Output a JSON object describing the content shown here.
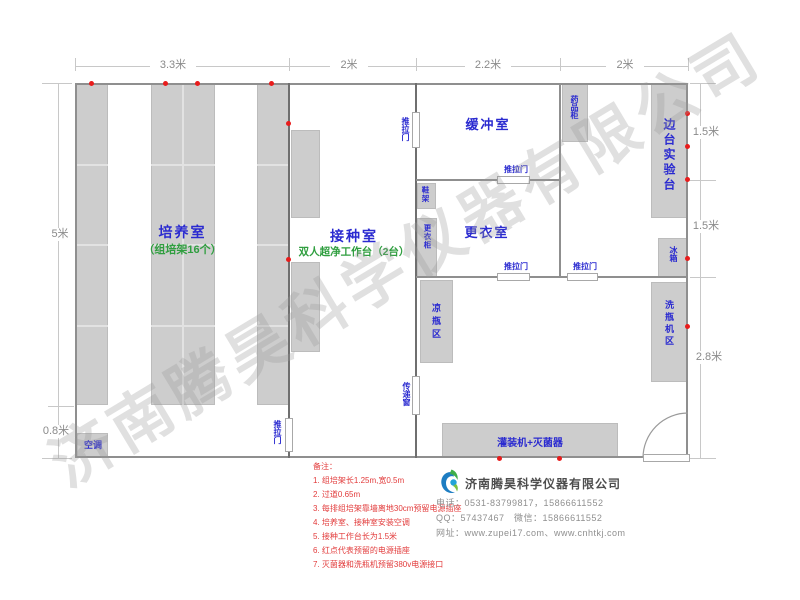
{
  "watermark": "济南腾昊科学仪器有限公司",
  "dimensions": {
    "top": [
      "3.3米",
      "2米",
      "2.2米",
      "2米"
    ],
    "left": [
      "5米",
      "0.8米"
    ],
    "right": [
      "1.5米",
      "1.5米",
      "2.8米"
    ]
  },
  "rooms": {
    "cultivation": {
      "name": "培养室",
      "sub": "（组培架16个）"
    },
    "inoculation": {
      "name": "接种室",
      "sub": "双人超净工作台（2台）"
    },
    "buffer": {
      "name": "缓冲室"
    },
    "dressing": {
      "name": "更衣室"
    },
    "side_bench": {
      "name": "边台实验台"
    }
  },
  "fixtures": {
    "air_conditioner": "空调",
    "sliding_door": "推拉门",
    "transfer_window": "传递窗",
    "medicine_cabinet": "药品柜",
    "shoe_rack": "鞋架",
    "wardrobe": "更衣柜",
    "fridge": "冰箱",
    "bottle_cooling_area": "凉瓶区",
    "bottle_washer_area": "洗瓶机区",
    "filling_sterilizer": "灌装机+灭菌器"
  },
  "notes": {
    "title": "备注：",
    "items": [
      "1. 组培架长1.25m,宽0.5m",
      "2. 过道0.65m",
      "3. 每排组培架靠墙离地30cm预留电源插座",
      "4. 培养室、接种室安装空调",
      "5. 接种工作台长为1.5米",
      "6. 红点代表预留的电源插座",
      "7. 灭菌器和洗瓶机预留380v电源接口"
    ]
  },
  "company": {
    "name": "济南腾昊科学仪器有限公司",
    "phone": "电话：0531-83799817，15866611552",
    "qq": "QQ：57437467　微信：15866611552",
    "website": "网址：www.zupei17.com、www.cnhtkj.com"
  },
  "colors": {
    "label_blue": "#2a2ad0",
    "label_green": "#2f9e3f",
    "note_red": "#e23b3b",
    "dot_red": "#e81c1c",
    "block_grey": "#cdcdcd"
  }
}
